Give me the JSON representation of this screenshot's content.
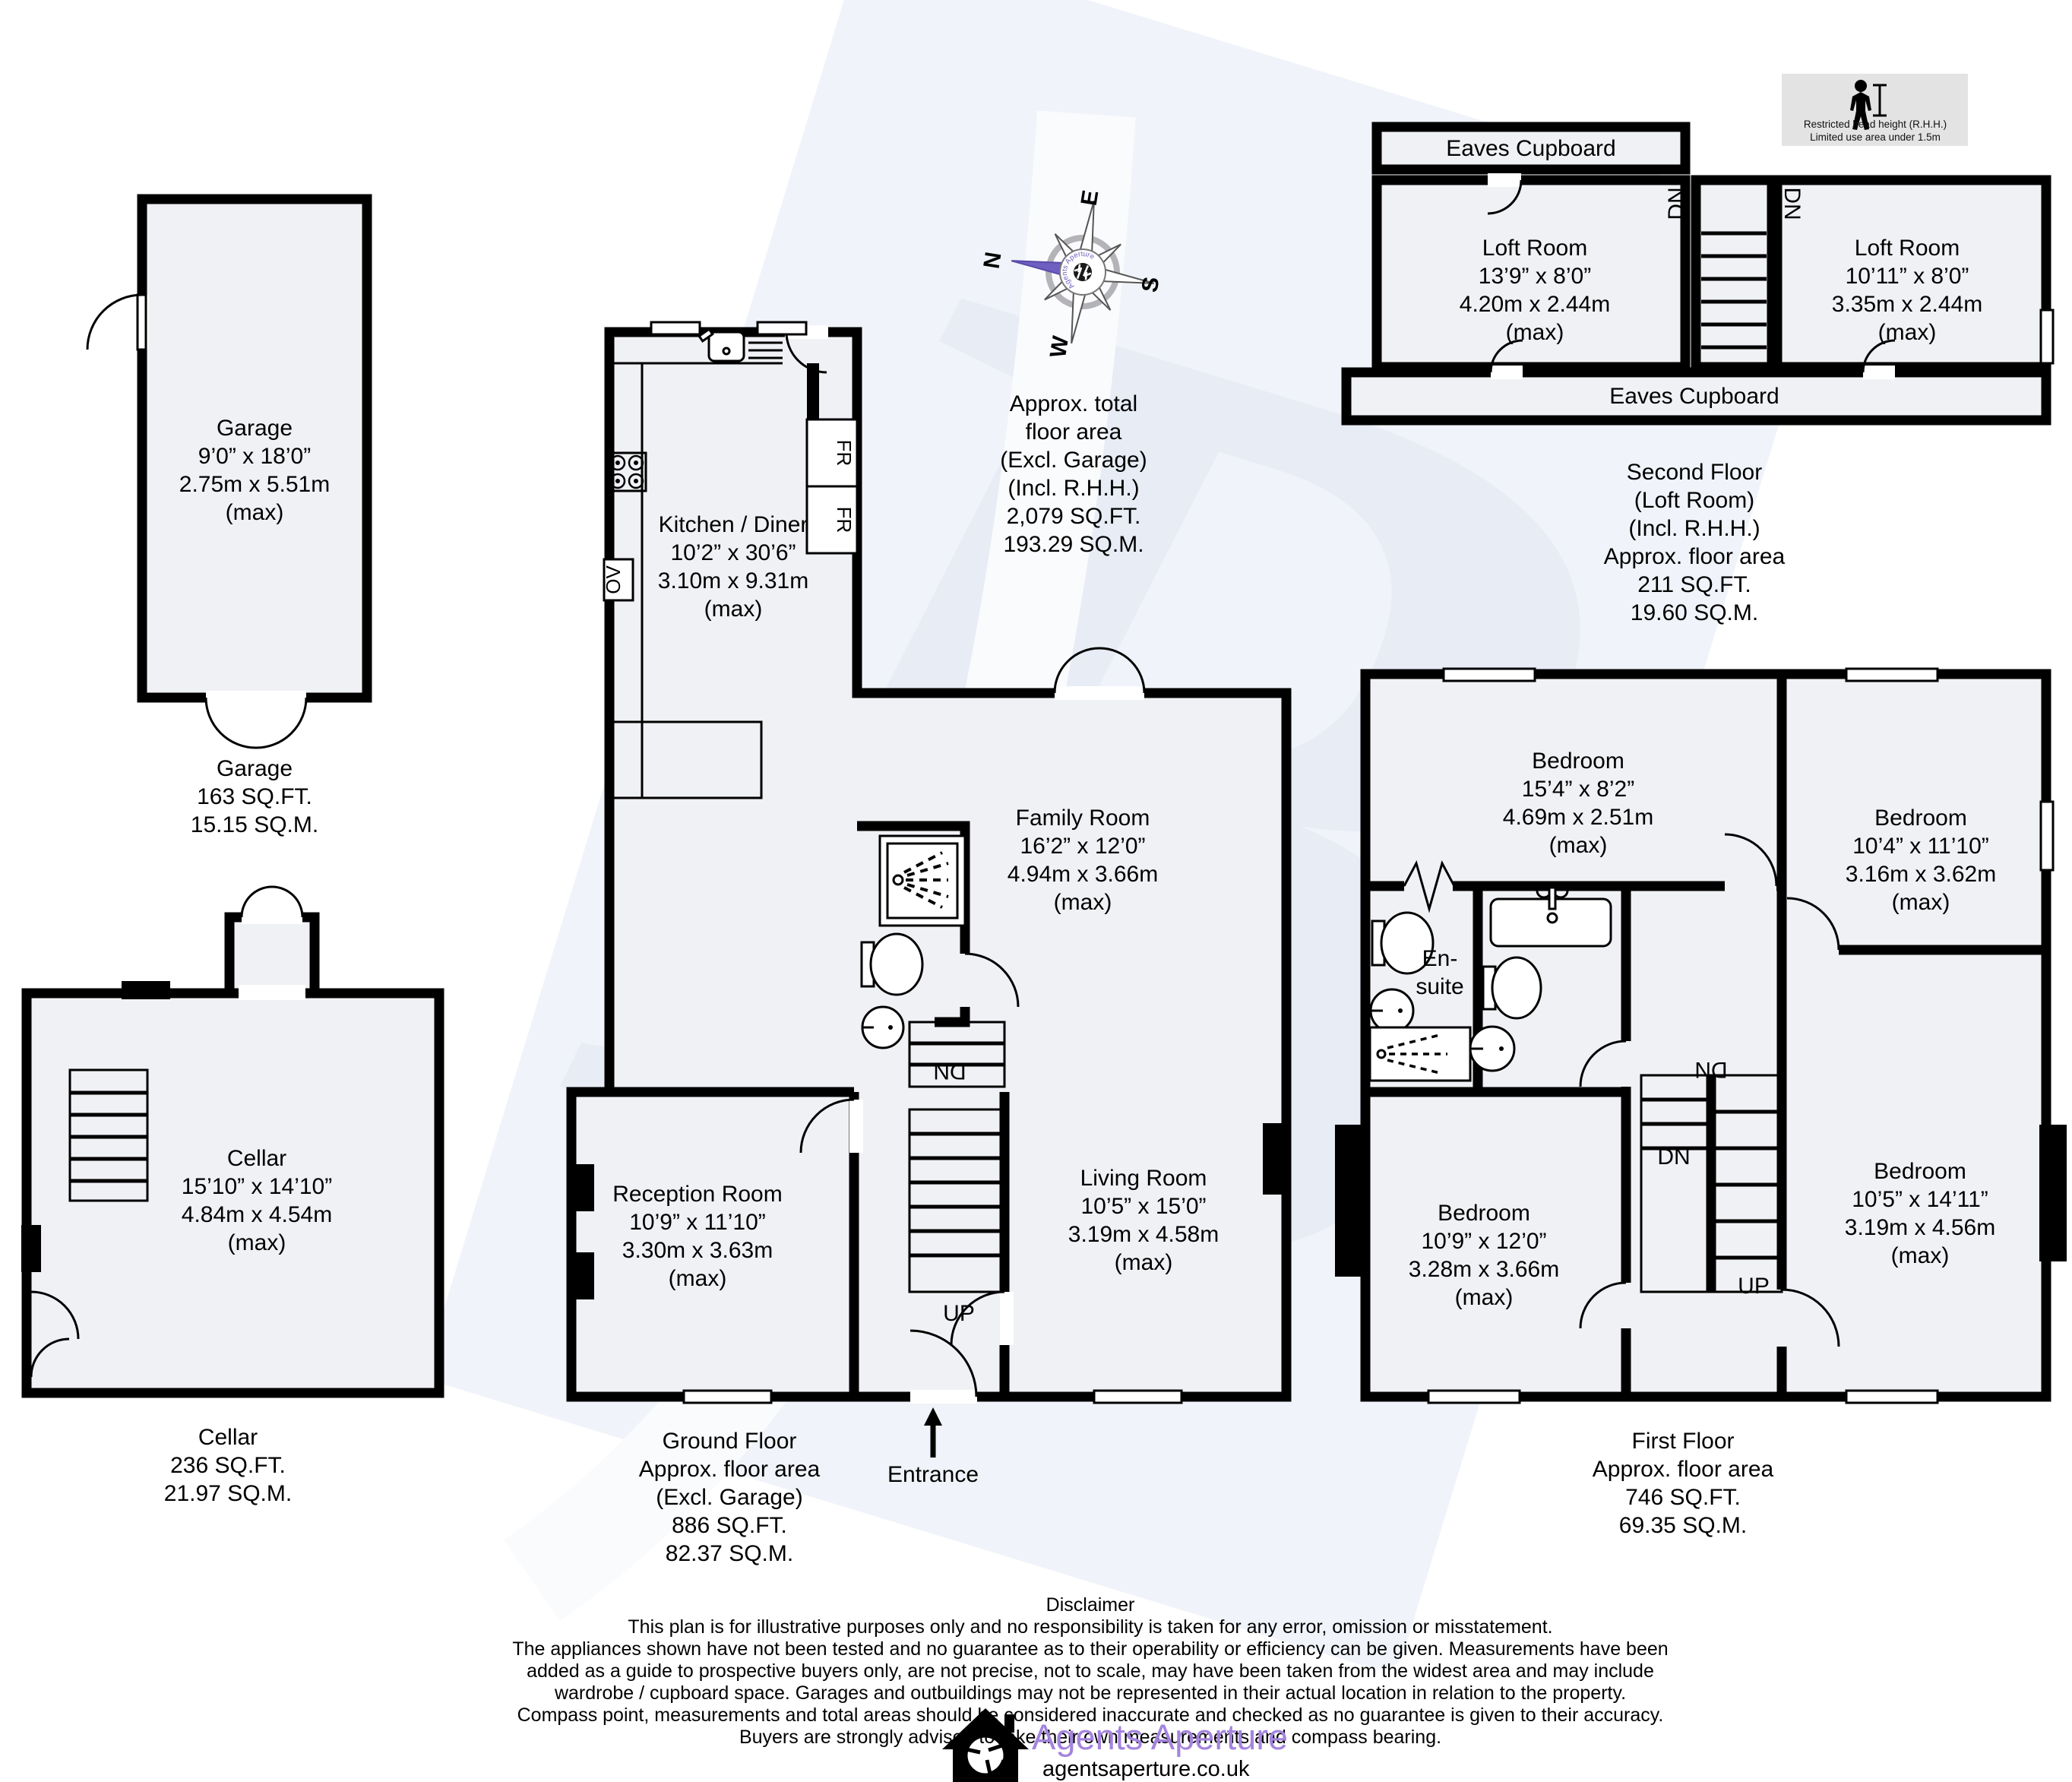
{
  "watermark_letter": "B",
  "rhh": {
    "line1": "Restricted head height (R.H.H.)",
    "line2": "Limited use area under 1.5m"
  },
  "compass": {
    "n": "N",
    "e": "E",
    "s": "S",
    "w": "W",
    "brand": "Agents Aperture"
  },
  "total_area": "Approx. total\nfloor area\n(Excl. Garage)\n(Incl. R.H.H.)\n2,079 SQ.FT.\n193.29 SQ.M.",
  "floors": {
    "garage": {
      "room": "Garage\n9’0” x 18’0”\n2.75m x 5.51m\n(max)",
      "footer": "Garage\n163 SQ.FT.\n15.15 SQ.M."
    },
    "cellar": {
      "room": "Cellar\n15’10” x 14’10”\n4.84m x 4.54m\n(max)",
      "footer": "Cellar\n236 SQ.FT.\n21.97 SQ.M."
    },
    "ground": {
      "kitchen": "Kitchen / Diner\n10’2” x 30’6”\n3.10m x 9.31m\n(max)",
      "family": "Family Room\n16’2” x 12’0”\n4.94m x 3.66m\n(max)",
      "reception": "Reception Room\n10’9” x 11’10”\n3.30m x 3.63m\n(max)",
      "living": "Living Room\n10’5” x 15’0”\n3.19m x 4.58m\n(max)",
      "entrance": "Entrance",
      "up": "UP",
      "dn": "DN",
      "footer": "Ground Floor\nApprox. floor area\n(Excl. Garage)\n886 SQ.FT.\n82.37 SQ.M."
    },
    "first": {
      "bed1": "Bedroom\n15’4” x 8’2”\n4.69m x 2.51m\n(max)",
      "bed2": "Bedroom\n10’4” x 11’10”\n3.16m x 3.62m\n(max)",
      "bed3": "Bedroom\n10’9” x 12’0”\n3.28m x 3.66m\n(max)",
      "bed4": "Bedroom\n10’5” x 14’11”\n3.19m x 4.56m\n(max)",
      "ensuite": "En-\nsuite",
      "up": "UP",
      "dn_upper": "DN",
      "dn_lower": "DN",
      "footer": "First Floor\nApprox. floor area\n746 SQ.FT.\n69.35 SQ.M."
    },
    "second": {
      "eaves_top": "Eaves Cupboard",
      "eaves_bottom": "Eaves Cupboard",
      "loft_left": "Loft Room\n13’9” x 8’0”\n4.20m x 2.44m\n(max)",
      "loft_right": "Loft Room\n10’11” x 8’0”\n3.35m x 2.44m\n(max)",
      "dn_left": "DN",
      "dn_right": "DN",
      "footer": "Second Floor\n(Loft Room)\n(Incl. R.H.H.)\nApprox. floor area\n211 SQ.FT.\n19.60 SQ.M."
    }
  },
  "appliances": {
    "fr1": "FR",
    "fr2": "FR",
    "ov": "OV"
  },
  "disclaimer": {
    "title": "Disclaimer",
    "body": "This plan is for illustrative purposes only and no responsibility is taken for any error, omission or misstatement.\nThe appliances shown have not been tested and no guarantee as to their operability or efficiency can be given. Measurements have been\nadded as a guide to prospective buyers only, are not precise, not to scale, may have been taken from the widest area and may include\nwardrobe / cupboard space. Garages and outbuildings may not be represented in their actual location in relation to  the property.\nCompass point, measurements and total areas should be considered inaccurate and checked as no guarantee is given to their accuracy.\nBuyers are strongly advised to take their own measurements and compass bearing."
  },
  "brand": {
    "name": "Agents Aperture",
    "url": "agentsaperture.co.uk"
  },
  "colors": {
    "accent_purple": "#a484de",
    "compass_purple": "#6f5fc0",
    "room_fill": "#f0f1f4",
    "wall": "#000000",
    "rhh_bg": "#e3e3e3",
    "watermark": "#e7ecf5"
  }
}
